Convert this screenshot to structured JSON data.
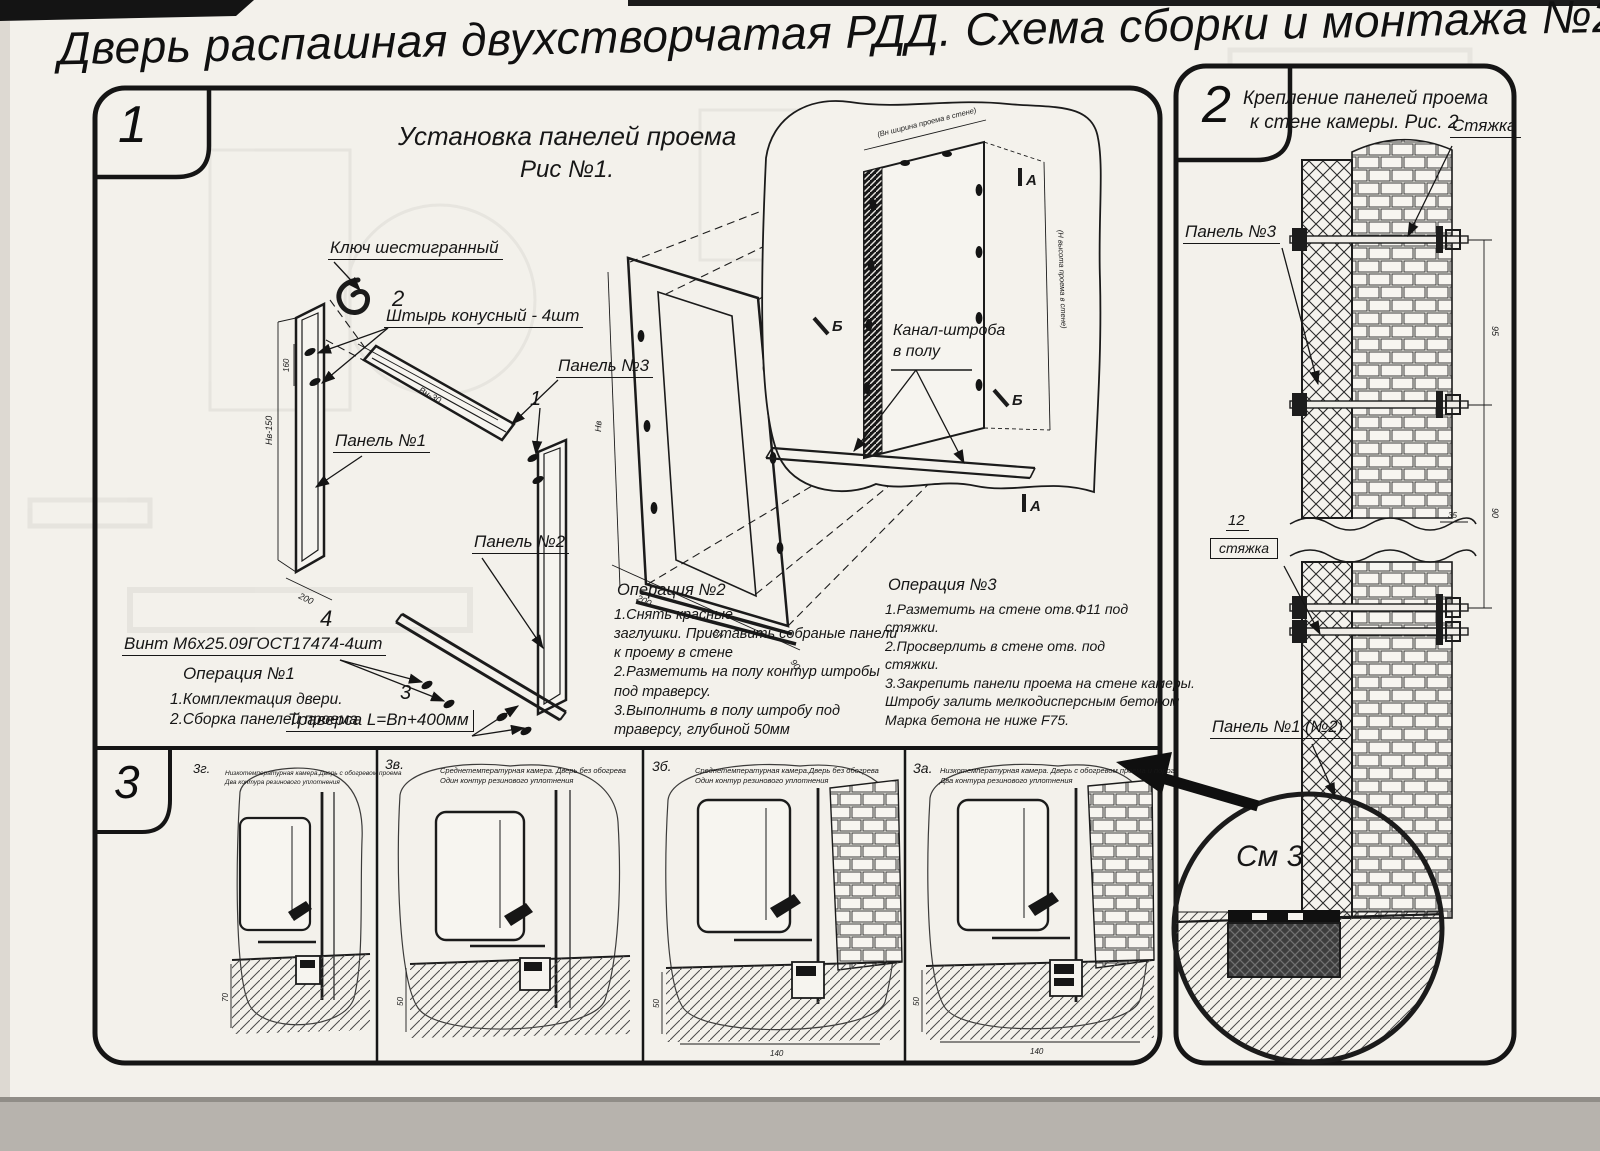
{
  "page": {
    "title": "Дверь распашная двухстворчатая РДД.  Схема сборки и монтажа №2"
  },
  "fig1": {
    "badge": "1",
    "caption_line1": "Установка панелей проема",
    "caption_line2": "Рис №1.",
    "label_hex_key": "Ключ шестигранный",
    "pin_no": "2",
    "label_pin": "Штырь конусный - 4шт",
    "label_panel3": "Панель №3",
    "label_panel1": "Панель №1",
    "callout_1": "1",
    "label_panel2": "Панель №2",
    "screw_no": "4",
    "label_screw": "Винт М6х25.09ГОСТ17474-4шт",
    "op1_title": "Операция №1",
    "op1_text": "1.Комплектация двери.\n2.Сборка панелей проема",
    "traverse_no": "3",
    "label_traverse": "Траверса  L=Bn+400мм",
    "op2_title": "Операция №2",
    "op2_text": "1.Снять красные\nзаглушки. Приставить собраные панели\nк проему в стене\n2.Разметить на полу контур штробы\nпод траверсу.\n3.Выполнить в полу штробу под\nтраверсу, глубиной 50мм",
    "op3_title": "Операция №3",
    "op3_text": "1.Разметить на стене отв.Ф11 под\nстяжки.\n2.Просверлить в стене отв.  под\nстяжки.\n3.Закрепить панели проема на стене камеры.\nШтробу залить мелкодисперсным бетоном\nМарка бетона не ниже  F75.",
    "label_channel": "Канал-штроба\nв полу",
    "marker_a": "А",
    "marker_b": "Б",
    "dim_nv150": "Нв-150",
    "dim_200a": "200",
    "dim_vn30": "Вн-30",
    "dim_160": "160",
    "dim_nv": "Нв",
    "dim_200b": "200",
    "dim_vn": "Вн",
    "dim_90": "90",
    "dim_width_note": "(Вн ширина проема в стене)",
    "dim_height_note": "(Н высота проема в стене)"
  },
  "fig2": {
    "badge": "2",
    "caption_line1": "Крепление панелей проема",
    "caption_line2": "к стене камеры. Рис. 2",
    "label_tie": "Стяжка",
    "label_panel3": "Панель №3",
    "tie12_no": "12",
    "tie12_label": "стяжка",
    "label_panel12": "Панель №1 (№2)",
    "see_detail": "См 3",
    "dim_95": "95",
    "dim_90": "90",
    "dim_35": "35"
  },
  "fig3": {
    "badge": "3",
    "dim_50": "50",
    "dim_70": "70",
    "dim_140": "140",
    "items": [
      {
        "id": "3г.",
        "caption": "Низкотемпературная камера.Дверь с обогревом проема\nДва контура резинового уплотнения"
      },
      {
        "id": "3в.",
        "caption": "Среднетемпературная камера. Дверь без обогрева\nОдин контур резинового уплотнения"
      },
      {
        "id": "3б.",
        "caption": "Среднетемпературная камера.Дверь без обогрева\nОдин контур резинового уплотнения"
      },
      {
        "id": "3а.",
        "caption": "Низкотемпературная камера. Дверь с обогревом проема и порога\nДва контура резинового уплотнения"
      }
    ]
  }
}
